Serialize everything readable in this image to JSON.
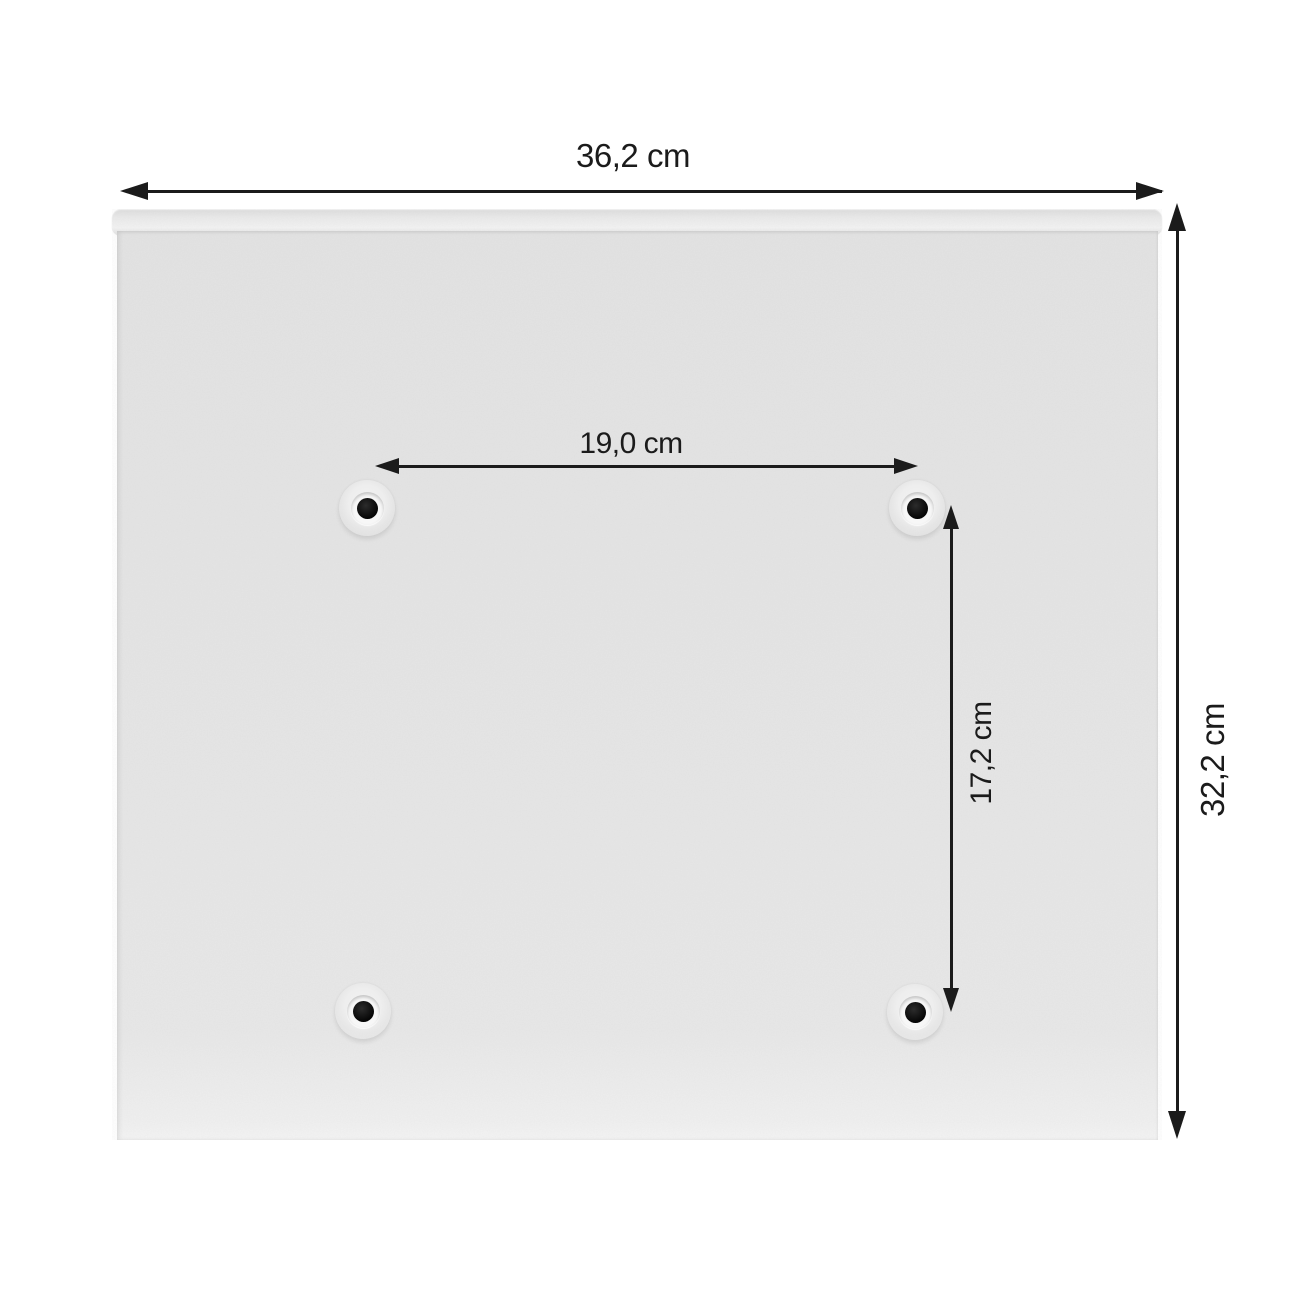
{
  "diagram": {
    "kind": "product-dimension-diagram",
    "subject": "back panel of a mailbox with four mounting holes",
    "dimensions": {
      "overall_width": {
        "label": "36,2 cm"
      },
      "overall_height": {
        "label": "32,2 cm"
      },
      "hole_spacing_horizontal": {
        "label": "19,0 cm"
      },
      "hole_spacing_vertical": {
        "label": "17,2 cm"
      }
    },
    "mounting_holes": {
      "count": 4
    },
    "colors": {
      "background": "#ffffff",
      "panel": "#e6e6e6",
      "panel_highlight": "#f3f3f3",
      "annotation": "#1b1b1b"
    }
  }
}
